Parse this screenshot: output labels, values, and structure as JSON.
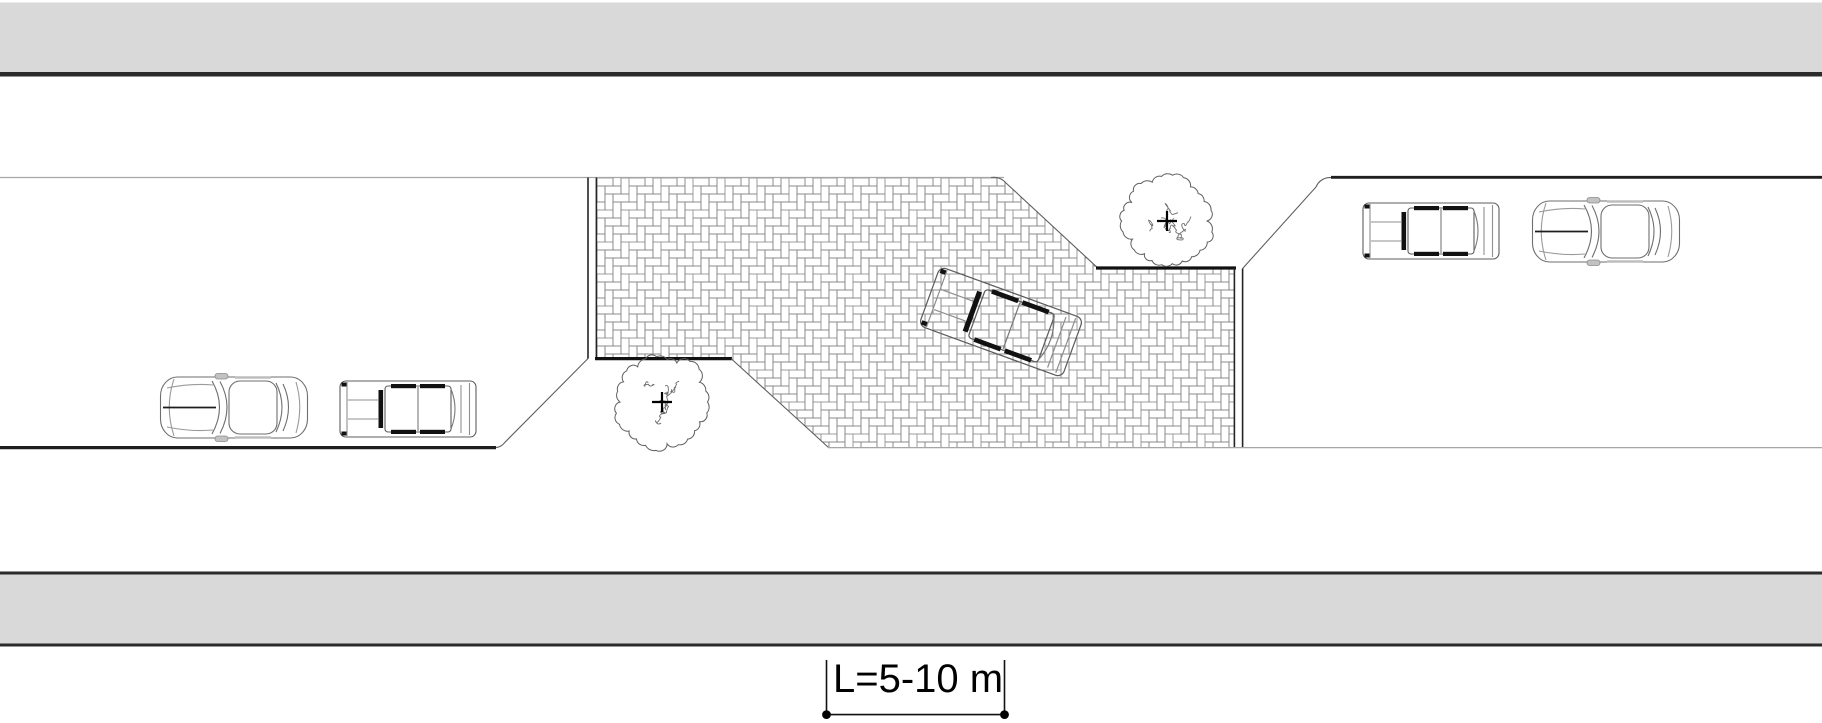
{
  "drawing": {
    "kind": "traffic-calming chicane street plan (top view)",
    "dimension_label": "L=5-10 m",
    "colors": {
      "sidewalk_fill": "#d9d9d9",
      "curb_dark": "#1f1f1f",
      "edge_light": "#a6a6a6",
      "paving_joint": "#858585",
      "tree_outline": "#5f5f5f"
    },
    "elements": {
      "sidewalks": 2,
      "trees": 2,
      "parked_cars": 4,
      "moving_cars": 1,
      "paved_area": "herringbone brick plateau with ramp edges"
    }
  }
}
